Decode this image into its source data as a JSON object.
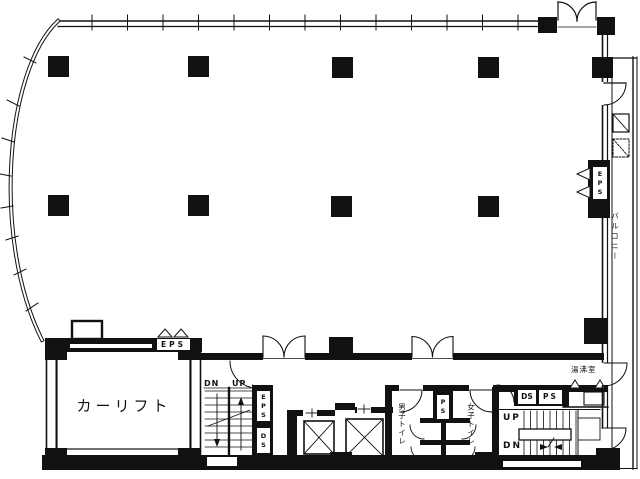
{
  "floor_plan": {
    "rooms": {
      "car_lift": "カーリフト",
      "balcony": "バルコニー",
      "mens_toilet": "男子トイレ",
      "womens_toilet": "女子トイレ",
      "hot_water_room": "湯沸室"
    },
    "shafts": {
      "eps_right_wall": "EPS",
      "eps_car_lift": "EPS",
      "eps_core": "EPS",
      "ds_core": "DS",
      "ps_toilet": "PS",
      "ds_service": "DS",
      "ps_service": "PS"
    },
    "stairs": {
      "left_dn": "DN",
      "left_up": "UP",
      "right_up": "UP",
      "right_dn": "DN"
    },
    "colors": {
      "line": "#111111",
      "background": "#ffffff"
    }
  }
}
